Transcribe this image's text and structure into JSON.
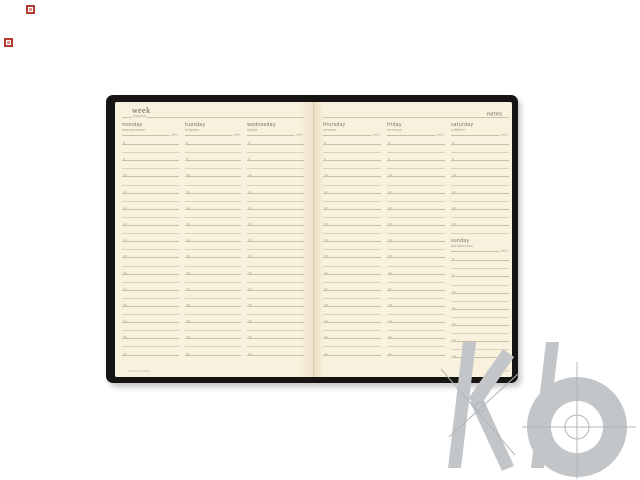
{
  "background": "#ffffff",
  "print_marks": {
    "color": "#b23b2e"
  },
  "watermark": {
    "letters": "kb",
    "color": "#c3c6c8",
    "line_color": "#b2b6b9"
  },
  "planner": {
    "cover_color": "#171514",
    "page_color": "#f8f1dd",
    "hours": [
      "8",
      "9",
      "10",
      "11",
      "12",
      "13",
      "14",
      "15",
      "16",
      "17",
      "18",
      "19",
      "20",
      "21"
    ],
    "left_page": {
      "title": "week",
      "subtitle": "неделя",
      "footer": "bruno visconti",
      "columns": [
        {
          "day": "monday",
          "day_ru": "понедельник",
          "date_label": "date"
        },
        {
          "day": "tuesday",
          "day_ru": "вторник",
          "date_label": "date"
        },
        {
          "day": "wednesday",
          "day_ru": "среда",
          "date_label": "date"
        }
      ]
    },
    "right_page": {
      "notes_label": "notes",
      "footer": "bruno visconti",
      "columns": [
        {
          "day": "thursday",
          "day_ru": "четверг",
          "date_label": "date"
        },
        {
          "day": "friday",
          "day_ru": "пятница",
          "date_label": "date"
        },
        {
          "day": "saturday",
          "day_ru": "суббота",
          "date_label": "date",
          "split": {
            "day": "sunday",
            "day_ru": "воскресенье",
            "date_label": "date"
          }
        }
      ]
    }
  }
}
